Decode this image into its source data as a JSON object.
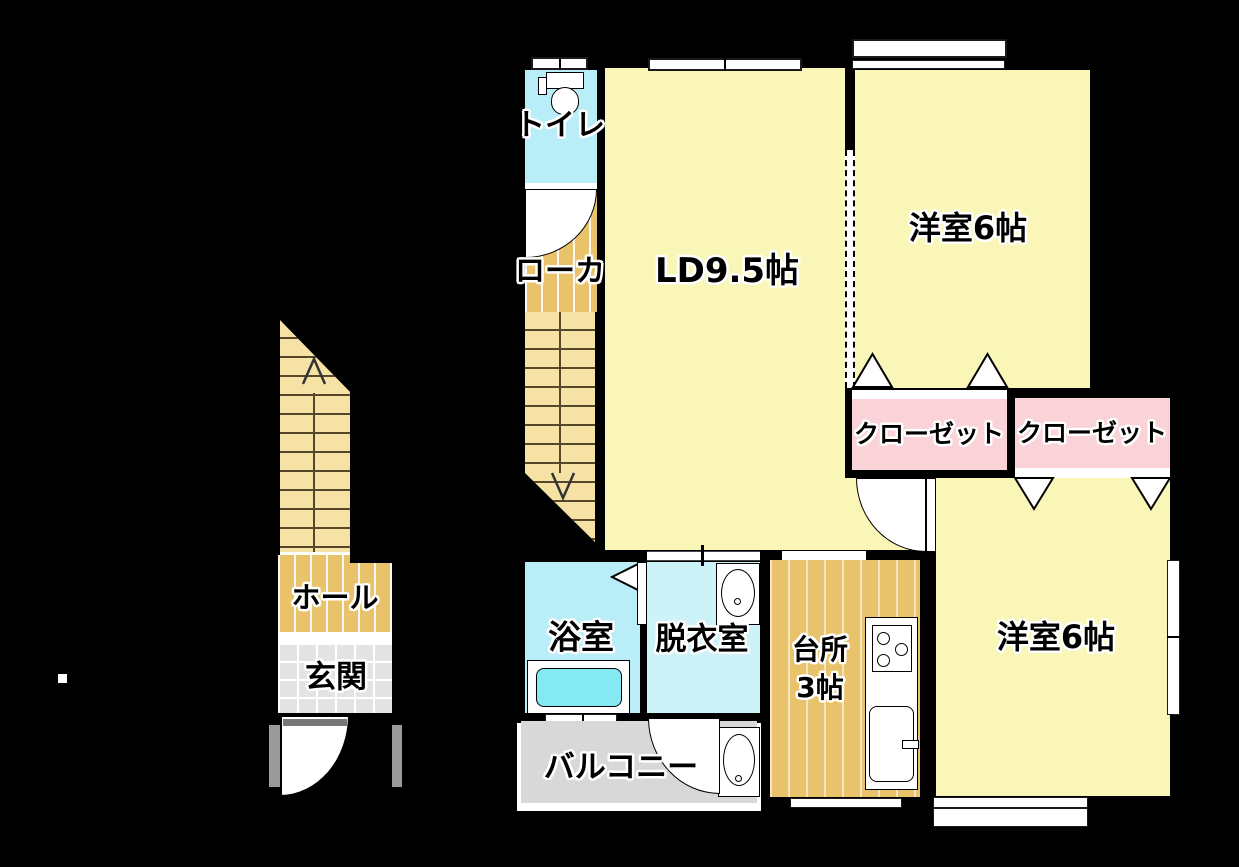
{
  "floorplan": {
    "rooms": {
      "toilet": {
        "label": "トイレ"
      },
      "corridor": {
        "label": "ローカ"
      },
      "living_dining": {
        "label": "LD9.5帖"
      },
      "bedroom_top": {
        "label": "洋室6帖"
      },
      "closet_left": {
        "label": "クローゼット"
      },
      "closet_right": {
        "label": "クローゼット"
      },
      "bedroom_bottom": {
        "label": "洋室6帖"
      },
      "kitchen": {
        "label_line1": "台所",
        "label_line2": "3帖"
      },
      "dressing_room": {
        "label": "脱衣室"
      },
      "bathroom": {
        "label": "浴室"
      },
      "balcony": {
        "label": "バルコニー"
      },
      "hall": {
        "label": "ホール"
      },
      "entrance": {
        "label": "玄関"
      }
    },
    "icons": {
      "stairs_up_arrow": "up-arrow-icon",
      "stairs_down_arrow": "down-arrow-icon",
      "toilet_fixture": "toilet-icon",
      "washbasin": "washbasin-icon",
      "utility_sink": "utility-sink-icon",
      "bathtub": "bathtub-icon",
      "stove": "stove-icon",
      "kitchen_sink": "kitchen-sink-icon"
    },
    "colors": {
      "background": "#000000",
      "wall": "#000000",
      "room_yellow": "#faf6b7",
      "closet_pink": "#f9d3d7",
      "wet_cyan": "#b9edf8",
      "dressing_cyan": "#cdf3f9",
      "tub_cyan": "#84e9f3",
      "stair_tan": "#f5e2a4",
      "wood_tan": "#e9c36c",
      "genkan_gray": "#e3e3e3",
      "balcony_gray": "#d8d8d8",
      "jamb_gray": "#9a9a9a"
    }
  }
}
